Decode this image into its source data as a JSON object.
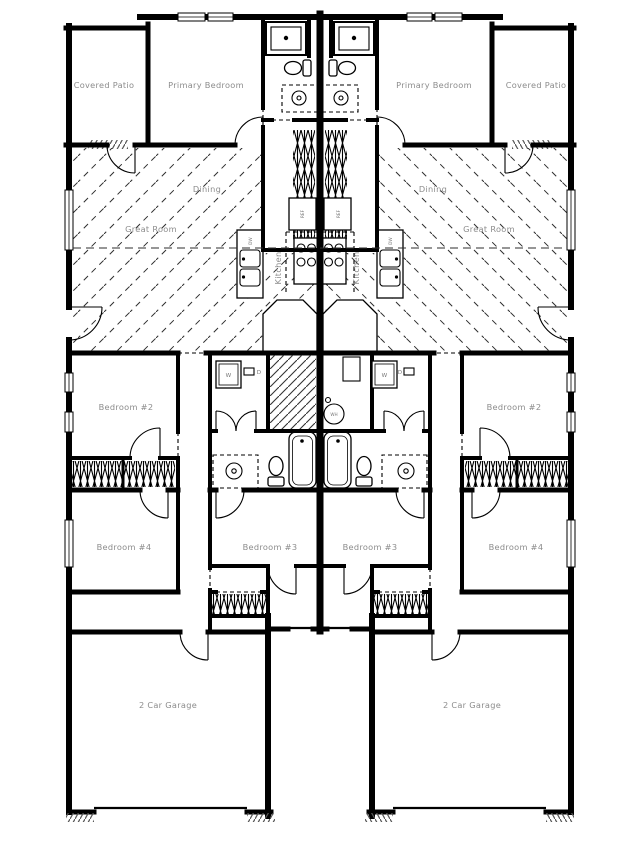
{
  "plan": {
    "type": "duplex-floor-plan",
    "units": 2,
    "colors": {
      "wall": "#000000",
      "room_label": "#8c8c8c",
      "fixture_label": "#777777",
      "background": "#ffffff"
    }
  },
  "rooms": {
    "covered_patio": "Covered Patio",
    "primary_bedroom": "Primary Bedroom",
    "dining": "Dining",
    "great_room": "Great Room",
    "kitchen": "Kitchen",
    "bedroom_2": "Bedroom #2",
    "bedroom_3": "Bedroom #3",
    "bedroom_4": "Bedroom #4",
    "garage": "2 Car Garage"
  },
  "fixtures": {
    "refrigerator": "REF",
    "dishwasher": "DW",
    "washer": "W",
    "dryer": "D",
    "water_heater": "WH"
  }
}
